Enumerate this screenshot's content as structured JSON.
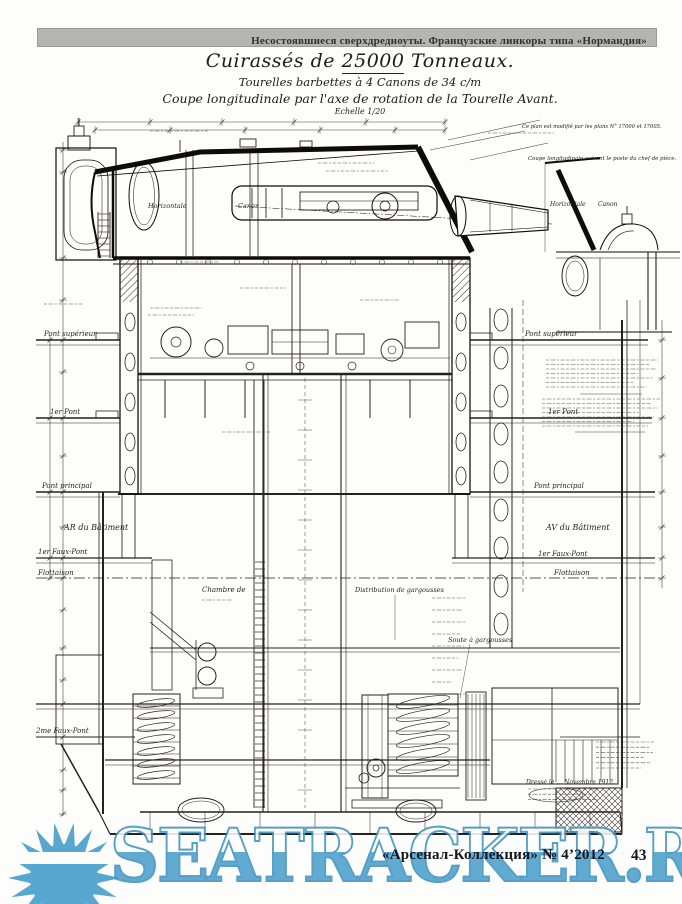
{
  "header": {
    "series_title": "Несостоявшиеся сверхдредноуты. Французские линкоры типа «Нормандия»"
  },
  "title_block": {
    "title_pre": "Cuirassés de ",
    "title_num": "25000",
    "title_post": " Tonneaux.",
    "subtitle": "Tourelles barbettes à 4 Canons de 34 c/m",
    "caption": "Coupe longitudinale par l'axe de rotation de la Tourelle Avant.",
    "scale": "Echelle 1/20"
  },
  "notes": {
    "top_right": "Ce plan est modifié par les plans N° 17000 et 17005.",
    "inset_caption": "Coupe longitudinale suivant le poste du chef de pièce.",
    "signature": "Dressé le … Novembre 1912."
  },
  "labels": {
    "horizontale": "Horizontale",
    "canon": "Canon",
    "chambre": "Chambre de",
    "distribution": "Distribution de gargousses",
    "soute_gargousses": "Soute à gargousses",
    "decks_left": [
      "Pont supérieur",
      "1er Pont",
      "Pont principal",
      "AR du Bâtiment",
      "1er Faux-Pont",
      "Flottaison",
      "2me Faux-Pont"
    ],
    "decks_right": [
      "Pont supérieur",
      "1er Pont",
      "Pont principal",
      "AV du Bâtiment",
      "1er Faux-Pont",
      "Flottaison"
    ]
  },
  "watermark": {
    "text": "SEATRACKER.RU",
    "color": "#4aa0cd"
  },
  "footer": {
    "journal": "«Арсенал-Коллекция» № 4’2012",
    "page_number": "43"
  }
}
